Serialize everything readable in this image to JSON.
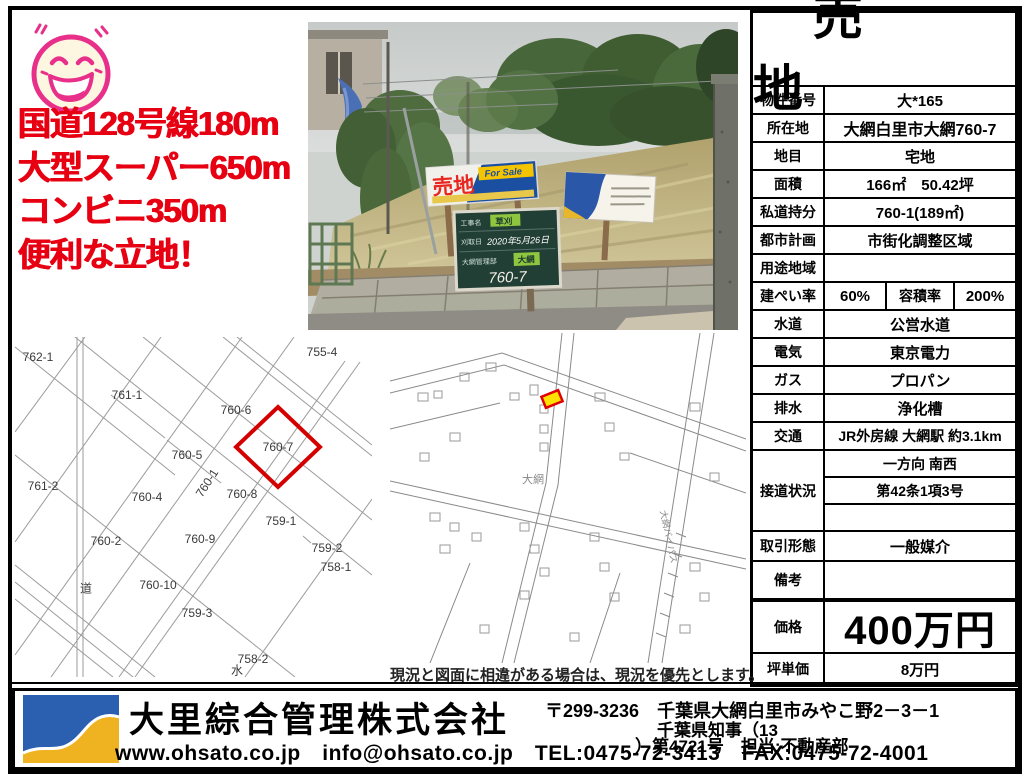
{
  "colors": {
    "accent_red": "#e60012",
    "smiley_pink": "#e8308a",
    "table_border": "#000000",
    "logo_blue": "#2b5fb0",
    "logo_yellow": "#efb321",
    "sign_blue": "#1b4fa2",
    "sign_yellow": "#f5c400",
    "map_highlight_stroke": "#d40000",
    "map_highlight_fill": "#ffe000"
  },
  "headline": {
    "lines": [
      "国道128号線180m",
      "大型スーパー650m",
      "コンビニ350m",
      "便利な立地！"
    ]
  },
  "smiley": {
    "icon": "laughing-face-icon"
  },
  "photo": {
    "sale_sign": {
      "title": "売地",
      "subtitle": "For Sale"
    },
    "board_sign": {
      "row1_label": "工事名",
      "row1_value": "草刈",
      "row2_label": "刈取日",
      "row2_value": "2020年5月26日",
      "row3_label": "大網管理部",
      "row3_value": "大網",
      "number": "760-7"
    }
  },
  "table": {
    "title": "売地",
    "rows": [
      {
        "label": "物件番号",
        "value": "大*165"
      },
      {
        "label": "所在地",
        "value": "大網白里市大網760-7"
      },
      {
        "label": "地目",
        "value": "宅地"
      },
      {
        "label": "面積",
        "value": "166㎡　50.42坪"
      },
      {
        "label": "私道持分",
        "value": "760-1(189㎡)"
      },
      {
        "label": "都市計画",
        "value": "市街化調整区域"
      },
      {
        "label": "用途地域",
        "value": ""
      }
    ],
    "coverage": {
      "label": "建ぺい率",
      "value": "60%",
      "label2": "容積率",
      "value2": "200%"
    },
    "rows2": [
      {
        "label": "水道",
        "value": "公営水道"
      },
      {
        "label": "電気",
        "value": "東京電力"
      },
      {
        "label": "ガス",
        "value": "プロパン"
      },
      {
        "label": "排水",
        "value": "浄化槽"
      },
      {
        "label": "交通",
        "value": "JR外房線 大網駅 約3.1km"
      }
    ],
    "road": {
      "label": "接道状況",
      "lines": [
        "一方向 南西",
        "第42条1項3号",
        ""
      ]
    },
    "rows3": [
      {
        "label": "取引形態",
        "value": "一般媒介"
      },
      {
        "label": "備考",
        "value": ""
      }
    ],
    "price": {
      "label": "価格",
      "value": "400万円"
    },
    "unit_price": {
      "label": "坪単価",
      "value": "8万円"
    }
  },
  "map_left": {
    "labels": [
      "762-1",
      "761-1",
      "755-4",
      "760-6",
      "760-7",
      "760-5",
      "761-2",
      "760-4",
      "760-1",
      "760-8",
      "759-1",
      "760-2",
      "759-2",
      "758-1",
      "道",
      "760-10",
      "760-9",
      "759-3",
      "758-2",
      "水"
    ],
    "highlight_parcel": "760-7"
  },
  "map_right": {
    "area_label": "大網",
    "road_label": "大網バイパス",
    "caption": "現況と図面に相違がある場合は、現況を優先とします。"
  },
  "footer": {
    "company": "大里綜合管理株式会社",
    "web_line": "www.ohsato.co.jp　info@ohsato.co.jp　TEL:0475-72-3413　FAX:0475-72-4001",
    "address": "〒299-3236　千葉県大網白里市みやこ野2－3－1",
    "license_line1": "千葉県知事（13",
    "license_line2": "）第4721号　担当:不動産部"
  }
}
